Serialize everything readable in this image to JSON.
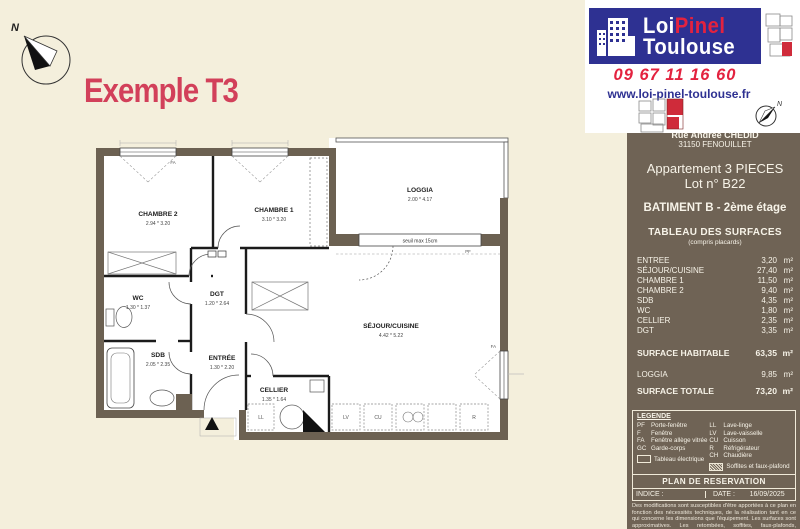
{
  "brand": {
    "name_part1": "Loi",
    "name_part2": "Pinel",
    "name_part3": "Toulouse",
    "phone": "09 67 11 16 60",
    "website": "www.loi-pinel-toulouse.fr",
    "blue": "#2e3192",
    "red": "#e3223f"
  },
  "title": "Exemple T3",
  "compass": {
    "north_label": "N"
  },
  "sidebar": {
    "address_line1": "Rue Andrée CHEDID",
    "address_line2": "31150 FENOUILLET",
    "apartment": "Appartement 3 PIECES",
    "lot": "Lot n° B22",
    "building": "BATIMENT B - 2ème étage",
    "table_title": "TABLEAU DES SURFACES",
    "table_subtitle": "(compris placards)",
    "unit": "m²",
    "rows": [
      {
        "label": "ENTREE",
        "value": "3,20"
      },
      {
        "label": "SÉJOUR/CUISINE",
        "value": "27,40"
      },
      {
        "label": "CHAMBRE 1",
        "value": "11,50"
      },
      {
        "label": "CHAMBRE 2",
        "value": "9,40"
      },
      {
        "label": "SDB",
        "value": "4,35"
      },
      {
        "label": "WC",
        "value": "1,80"
      },
      {
        "label": "CELLIER",
        "value": "2,35"
      },
      {
        "label": "DGT",
        "value": "3,35"
      }
    ],
    "habitable_label": "SURFACE HABITABLE",
    "habitable_value": "63,35",
    "loggia_label": "LOGGIA",
    "loggia_value": "9,85",
    "totale_label": "SURFACE TOTALE",
    "totale_value": "73,20"
  },
  "legend": {
    "title": "LEGENDE",
    "items_left": [
      {
        "abbr": "PF",
        "label": "Porte-fenêtre"
      },
      {
        "abbr": "F",
        "label": "Fenêtre"
      },
      {
        "abbr": "FA",
        "label": "Fenêtre allège vitrée"
      },
      {
        "abbr": "GC",
        "label": "Garde-corps"
      }
    ],
    "items_right": [
      {
        "abbr": "LL",
        "label": "Lave-linge"
      },
      {
        "abbr": "LV",
        "label": "Lave-vaisselle"
      },
      {
        "abbr": "CU",
        "label": "Cuisson"
      },
      {
        "abbr": "R",
        "label": "Réfrigérateur"
      },
      {
        "abbr": "CH",
        "label": "Chaudière"
      }
    ],
    "electrical": "Tableau électrique",
    "soffits": "Soffites et faux-plafond"
  },
  "footer": {
    "reservation": "PLAN DE RESERVATION",
    "indice_label": "INDICE :",
    "date_label": "DATE :",
    "date_value": "16/09/2025",
    "disclaimer": "Des modifications sont susceptibles d'être apportées à ce plan en fonction des nécessités techniques, de la réalisation tant en ce qui concerne les dimensions que l'équipement. Les surfaces sont approximatives. Les retombées, soffites, faux-plafonds, équipements..."
  },
  "plan": {
    "rooms": [
      {
        "name": "CHAMBRE 2",
        "dims": "2.94 * 3.20"
      },
      {
        "name": "CHAMBRE 1",
        "dims": "3.10 * 3.20"
      },
      {
        "name": "LOGGIA",
        "dims": "2.00 * 4.17"
      },
      {
        "name": "WC",
        "dims": "1.30 * 1.37"
      },
      {
        "name": "DGT",
        "dims": "1.20 * 2.64"
      },
      {
        "name": "SDB",
        "dims": "2.05 * 2.35"
      },
      {
        "name": "ENTRÉE",
        "dims": "1.30 * 2.20"
      },
      {
        "name": "CELLIER",
        "dims": "1.35 * 1.64"
      },
      {
        "name": "SÉJOUR/CUISINE",
        "dims": "4.42 * 5.22"
      }
    ],
    "annotations": {
      "seuil": "seuil max 15cm",
      "window_fa": "FA",
      "window_pf": "PF",
      "appliance_ll": "LL",
      "appliance_lv": "LV",
      "appliance_cu": "CU",
      "appliance_r": "R"
    }
  }
}
